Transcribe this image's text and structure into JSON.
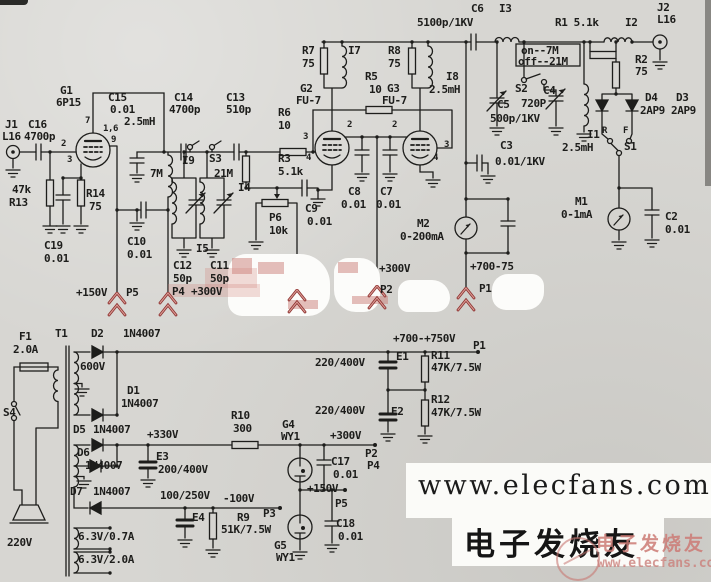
{
  "colors": {
    "paper": "#d7d6d2",
    "ink": "#1d1d1b",
    "arrow_red": "#8e3230",
    "arrow_red_soft": "#d99a93"
  },
  "watermark": {
    "site": "www.elecfans.com",
    "brand": "电子发烧友",
    "overlay_brand": "电子发烧友",
    "overlay_site": "www.elecfans.com"
  },
  "schematic": {
    "labels": [
      {
        "t": "J1",
        "x": 5,
        "y": 119
      },
      {
        "t": "L16",
        "x": 2,
        "y": 131
      },
      {
        "t": "C16",
        "x": 28,
        "y": 119
      },
      {
        "t": "4700p",
        "x": 24,
        "y": 131
      },
      {
        "t": "G1",
        "x": 60,
        "y": 85
      },
      {
        "t": "6P15",
        "x": 56,
        "y": 97
      },
      {
        "t": "C15",
        "x": 108,
        "y": 92
      },
      {
        "t": "0.01",
        "x": 110,
        "y": 104
      },
      {
        "t": "2.5mH",
        "x": 124,
        "y": 116
      },
      {
        "t": "47k",
        "x": 12,
        "y": 184
      },
      {
        "t": "R13",
        "x": 9,
        "y": 197
      },
      {
        "t": "R14",
        "x": 86,
        "y": 188
      },
      {
        "t": "75",
        "x": 89,
        "y": 201
      },
      {
        "t": "C19",
        "x": 44,
        "y": 240
      },
      {
        "t": "0.01",
        "x": 44,
        "y": 253
      },
      {
        "t": "C14",
        "x": 174,
        "y": 92
      },
      {
        "t": "4700p",
        "x": 169,
        "y": 104
      },
      {
        "t": "C13",
        "x": 226,
        "y": 92
      },
      {
        "t": "510p",
        "x": 226,
        "y": 104
      },
      {
        "t": "I9",
        "x": 182,
        "y": 155
      },
      {
        "t": "S3",
        "x": 209,
        "y": 153
      },
      {
        "t": "7M",
        "x": 150,
        "y": 168
      },
      {
        "t": "21M",
        "x": 214,
        "y": 168
      },
      {
        "t": "I4",
        "x": 238,
        "y": 182
      },
      {
        "t": "I5",
        "x": 196,
        "y": 243
      },
      {
        "t": "C12",
        "x": 173,
        "y": 260
      },
      {
        "t": "50p",
        "x": 173,
        "y": 273
      },
      {
        "t": "C11",
        "x": 210,
        "y": 260
      },
      {
        "t": "50p",
        "x": 210,
        "y": 273
      },
      {
        "t": "P4",
        "x": 172,
        "y": 286
      },
      {
        "t": "+300V",
        "x": 191,
        "y": 286
      },
      {
        "t": "C10",
        "x": 127,
        "y": 236
      },
      {
        "t": "0.01",
        "x": 127,
        "y": 249
      },
      {
        "t": "+150V",
        "x": 76,
        "y": 287
      },
      {
        "t": "P5",
        "x": 126,
        "y": 287
      },
      {
        "t": "R6",
        "x": 278,
        "y": 107
      },
      {
        "t": "10",
        "x": 278,
        "y": 120
      },
      {
        "t": "R3",
        "x": 278,
        "y": 153
      },
      {
        "t": "5.1k",
        "x": 278,
        "y": 166
      },
      {
        "t": "G2",
        "x": 300,
        "y": 83
      },
      {
        "t": "FU-7",
        "x": 296,
        "y": 95
      },
      {
        "t": "G3",
        "x": 387,
        "y": 83
      },
      {
        "t": "FU-7",
        "x": 382,
        "y": 95
      },
      {
        "t": "R7",
        "x": 302,
        "y": 45
      },
      {
        "t": "75",
        "x": 302,
        "y": 58
      },
      {
        "t": "I7",
        "x": 348,
        "y": 45
      },
      {
        "t": "R8",
        "x": 388,
        "y": 45
      },
      {
        "t": "75",
        "x": 388,
        "y": 58
      },
      {
        "t": "R5",
        "x": 365,
        "y": 71
      },
      {
        "t": "10",
        "x": 369,
        "y": 84
      },
      {
        "t": "I8",
        "x": 446,
        "y": 71
      },
      {
        "t": "2.5mH",
        "x": 429,
        "y": 84
      },
      {
        "t": "5100p/1KV",
        "x": 417,
        "y": 17
      },
      {
        "t": "C6",
        "x": 471,
        "y": 3
      },
      {
        "t": "I3",
        "x": 499,
        "y": 3
      },
      {
        "t": "on--7M",
        "x": 521,
        "y": 45
      },
      {
        "t": "off--21M",
        "x": 518,
        "y": 56
      },
      {
        "t": "S2",
        "x": 515,
        "y": 83
      },
      {
        "t": "C4",
        "x": 543,
        "y": 85
      },
      {
        "t": "720P",
        "x": 521,
        "y": 98
      },
      {
        "t": "C5",
        "x": 497,
        "y": 99
      },
      {
        "t": "500p/1KV",
        "x": 490,
        "y": 113
      },
      {
        "t": "C3",
        "x": 500,
        "y": 140
      },
      {
        "t": "0.01/1KV",
        "x": 495,
        "y": 156
      },
      {
        "t": "R1 5.1k",
        "x": 555,
        "y": 17
      },
      {
        "t": "I2",
        "x": 625,
        "y": 17
      },
      {
        "t": "J2",
        "x": 657,
        "y": 2
      },
      {
        "t": "L16",
        "x": 657,
        "y": 14
      },
      {
        "t": "R2",
        "x": 635,
        "y": 54
      },
      {
        "t": "75",
        "x": 635,
        "y": 66
      },
      {
        "t": "D4",
        "x": 645,
        "y": 92
      },
      {
        "t": "D3",
        "x": 676,
        "y": 92
      },
      {
        "t": "2AP9",
        "x": 640,
        "y": 105
      },
      {
        "t": "2AP9",
        "x": 671,
        "y": 105
      },
      {
        "t": "I1",
        "x": 587,
        "y": 129
      },
      {
        "t": "2.5mH",
        "x": 562,
        "y": 142
      },
      {
        "t": "R",
        "x": 602,
        "y": 127,
        "s": 9
      },
      {
        "t": "F",
        "x": 623,
        "y": 127,
        "s": 9
      },
      {
        "t": "S1",
        "x": 624,
        "y": 141
      },
      {
        "t": "C8",
        "x": 348,
        "y": 186
      },
      {
        "t": "0.01",
        "x": 341,
        "y": 199
      },
      {
        "t": "C7",
        "x": 380,
        "y": 186
      },
      {
        "t": "0.01",
        "x": 376,
        "y": 199
      },
      {
        "t": "C9",
        "x": 305,
        "y": 203
      },
      {
        "t": "0.01",
        "x": 307,
        "y": 216
      },
      {
        "t": "P6",
        "x": 269,
        "y": 212
      },
      {
        "t": "10k",
        "x": 269,
        "y": 225
      },
      {
        "t": "M2",
        "x": 417,
        "y": 218
      },
      {
        "t": "0-200mA",
        "x": 400,
        "y": 231
      },
      {
        "t": "+300V",
        "x": 379,
        "y": 263
      },
      {
        "t": "P2",
        "x": 380,
        "y": 284
      },
      {
        "t": "+700-75",
        "x": 470,
        "y": 261
      },
      {
        "t": "P1",
        "x": 479,
        "y": 283
      },
      {
        "t": "M1",
        "x": 575,
        "y": 196
      },
      {
        "t": "0-1mA",
        "x": 561,
        "y": 209
      },
      {
        "t": "C2",
        "x": 665,
        "y": 211
      },
      {
        "t": "0.01",
        "x": 665,
        "y": 224
      },
      {
        "t": "7",
        "x": 85,
        "y": 117,
        "s": 9
      },
      {
        "t": "1,6",
        "x": 103,
        "y": 125,
        "s": 9
      },
      {
        "t": "9",
        "x": 111,
        "y": 136,
        "s": 9
      },
      {
        "t": "2",
        "x": 61,
        "y": 140,
        "s": 9
      },
      {
        "t": "3",
        "x": 67,
        "y": 156,
        "s": 9
      },
      {
        "t": "2",
        "x": 347,
        "y": 121,
        "s": 9
      },
      {
        "t": "3",
        "x": 303,
        "y": 133,
        "s": 9
      },
      {
        "t": "4",
        "x": 306,
        "y": 154,
        "s": 9
      },
      {
        "t": "2",
        "x": 392,
        "y": 121,
        "s": 9
      },
      {
        "t": "3",
        "x": 444,
        "y": 141,
        "s": 9
      },
      {
        "t": "4",
        "x": 433,
        "y": 154,
        "s": 9
      },
      {
        "t": "F1",
        "x": 19,
        "y": 331
      },
      {
        "t": "2.0A",
        "x": 13,
        "y": 344
      },
      {
        "t": "T1",
        "x": 55,
        "y": 328
      },
      {
        "t": "D2",
        "x": 91,
        "y": 328
      },
      {
        "t": "1N4007",
        "x": 123,
        "y": 328
      },
      {
        "t": "600V",
        "x": 80,
        "y": 361
      },
      {
        "t": "D1",
        "x": 127,
        "y": 385
      },
      {
        "t": "1N4007",
        "x": 121,
        "y": 398
      },
      {
        "t": "S4",
        "x": 3,
        "y": 407
      },
      {
        "t": "220V",
        "x": 7,
        "y": 537
      },
      {
        "t": "D5",
        "x": 73,
        "y": 424
      },
      {
        "t": "1N4007",
        "x": 93,
        "y": 424
      },
      {
        "t": "+330V",
        "x": 147,
        "y": 429
      },
      {
        "t": "D6",
        "x": 77,
        "y": 447
      },
      {
        "t": "1N4007",
        "x": 85,
        "y": 460
      },
      {
        "t": "E3",
        "x": 156,
        "y": 451
      },
      {
        "t": "200/400V",
        "x": 158,
        "y": 464
      },
      {
        "t": "D7",
        "x": 70,
        "y": 486
      },
      {
        "t": "1N4007",
        "x": 93,
        "y": 486
      },
      {
        "t": "100/250V",
        "x": 160,
        "y": 490
      },
      {
        "t": "-100V",
        "x": 223,
        "y": 493
      },
      {
        "t": "E4",
        "x": 192,
        "y": 512
      },
      {
        "t": "R9",
        "x": 237,
        "y": 512
      },
      {
        "t": "51K/7.5W",
        "x": 221,
        "y": 524
      },
      {
        "t": "P3",
        "x": 263,
        "y": 508
      },
      {
        "t": "6.3V/0.7A",
        "x": 78,
        "y": 531
      },
      {
        "t": "6.3V/2.0A",
        "x": 78,
        "y": 554
      },
      {
        "t": "R10",
        "x": 231,
        "y": 410
      },
      {
        "t": "300",
        "x": 233,
        "y": 423
      },
      {
        "t": "G4",
        "x": 282,
        "y": 419
      },
      {
        "t": "WY1",
        "x": 281,
        "y": 431
      },
      {
        "t": "+300V",
        "x": 330,
        "y": 430
      },
      {
        "t": "P2",
        "x": 365,
        "y": 448
      },
      {
        "t": "P4",
        "x": 367,
        "y": 460
      },
      {
        "t": "C17",
        "x": 331,
        "y": 456
      },
      {
        "t": "0.01",
        "x": 333,
        "y": 469
      },
      {
        "t": "+150V",
        "x": 307,
        "y": 483
      },
      {
        "t": "P5",
        "x": 335,
        "y": 498
      },
      {
        "t": "G5",
        "x": 274,
        "y": 540
      },
      {
        "t": "WY1",
        "x": 276,
        "y": 552
      },
      {
        "t": "C18",
        "x": 336,
        "y": 518
      },
      {
        "t": "0.01",
        "x": 338,
        "y": 531
      },
      {
        "t": "+700-+750V",
        "x": 393,
        "y": 333
      },
      {
        "t": "P1",
        "x": 473,
        "y": 340
      },
      {
        "t": "E1",
        "x": 396,
        "y": 351
      },
      {
        "t": "220/400V",
        "x": 315,
        "y": 357
      },
      {
        "t": "R11",
        "x": 431,
        "y": 350
      },
      {
        "t": "47K/7.5W",
        "x": 431,
        "y": 362
      },
      {
        "t": "E2",
        "x": 391,
        "y": 406
      },
      {
        "t": "220/400V",
        "x": 315,
        "y": 405
      },
      {
        "t": "R12",
        "x": 431,
        "y": 394
      },
      {
        "t": "47K/7.5W",
        "x": 431,
        "y": 407
      }
    ],
    "red_arrows": [
      {
        "x": 117,
        "y": 292
      },
      {
        "x": 168,
        "y": 292
      },
      {
        "x": 297,
        "y": 289
      },
      {
        "x": 377,
        "y": 285
      },
      {
        "x": 466,
        "y": 287
      }
    ]
  }
}
